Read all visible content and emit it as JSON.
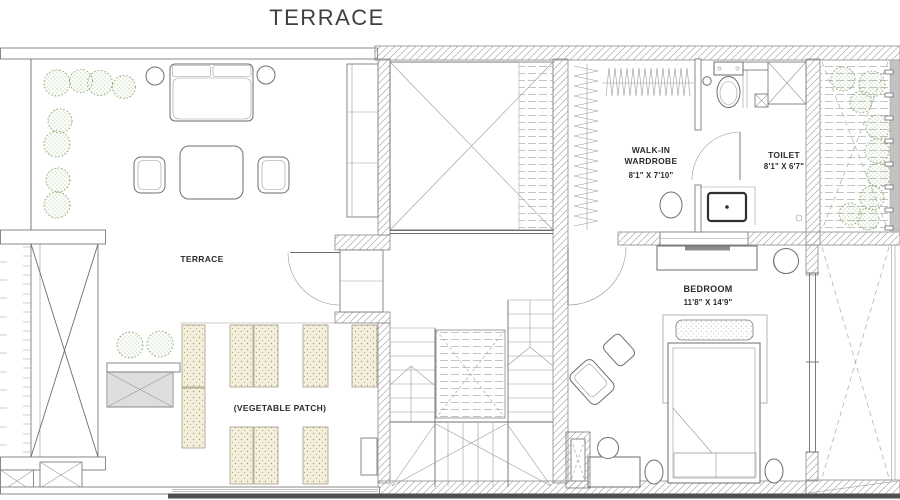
{
  "title": "TERRACE",
  "plan": {
    "rooms": {
      "terrace": {
        "label": "TERRACE"
      },
      "vegetable_patch": {
        "label": "(VEGETABLE PATCH)"
      },
      "walk_in_wardrobe": {
        "label_line1": "WALK-IN",
        "label_line2": "WARDROBE",
        "dimensions": "8'1\" X 7'10\""
      },
      "toilet": {
        "label": "TOILET",
        "dimensions": "8'1\" X 6'7\""
      },
      "bedroom": {
        "label": "BEDROOM",
        "dimensions": "11'8\" X 14'9\""
      }
    },
    "colors": {
      "line": "#6e6e6e",
      "wall_hatch": "#8a8a8a",
      "label_text": "#2b2b2b",
      "title_text": "#3f3f3f",
      "tree_green": "#8aa86d",
      "veg_bed_fill": "#f4efdc",
      "veg_bed_dot": "#ab9f72",
      "dark_base_bar": "#4f4f4f",
      "louver_strip": "#c2c2c2"
    }
  }
}
